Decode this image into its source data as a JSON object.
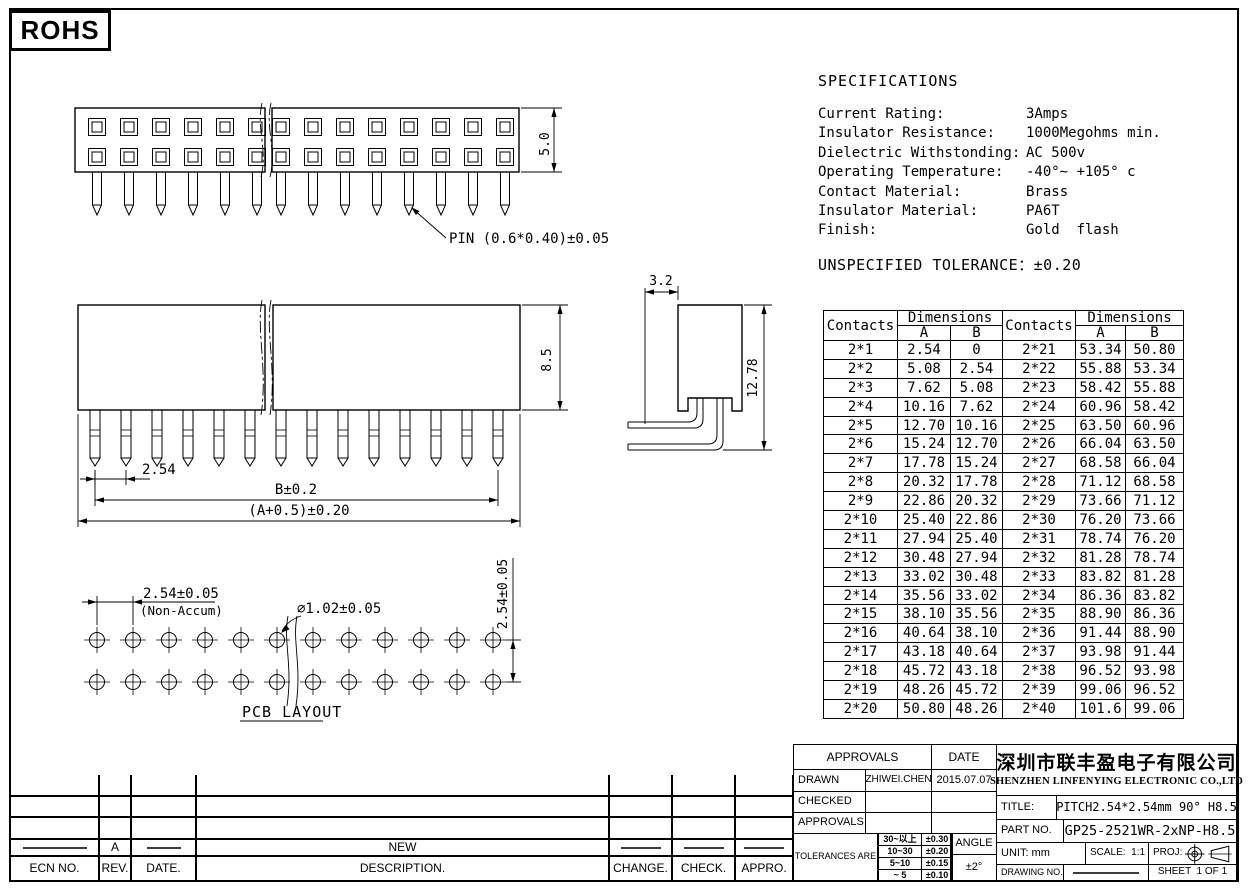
{
  "page": {
    "rohs_label": "ROHS"
  },
  "drawings": {
    "top_view": {
      "pin_label": "PIN (0.6*0.40)±0.05",
      "height_dim": "5.0"
    },
    "front_view": {
      "height_dim": "8.5",
      "pitch_dim": "2.54",
      "row_length_dim": "B±0.2",
      "total_length_dim": "(A+0.5)±0.20"
    },
    "side_view": {
      "depth_dim": "3.2",
      "height_dim": "12.78"
    },
    "pcb_layout": {
      "pitch_dim": "2.54±0.05",
      "pitch_note": "(Non-Accum)",
      "hole_dim": "∅1.02±0.05",
      "row_pitch_dim": "2.54±0.05",
      "caption": "PCB LAYOUT"
    }
  },
  "specifications": {
    "title": "SPECIFICATIONS",
    "items": [
      {
        "label": "Current Rating:",
        "value": "3Amps"
      },
      {
        "label": "Insulator Resistance:",
        "value": "1000Megohms min."
      },
      {
        "label": "Dielectric Withstonding:",
        "value": "AC 500v"
      },
      {
        "label": "Operating Temperature:",
        "value": "-40°∼ +105° c"
      },
      {
        "label": "Contact Material:",
        "value": "Brass"
      },
      {
        "label": "Insulator Material:",
        "value": "PA6T"
      },
      {
        "label": "Finish:",
        "value": "Gold  flash"
      }
    ],
    "tolerance_note": "UNSPECIFIED TOLERANCE：±0.20"
  },
  "dimensions_table": {
    "header": {
      "contacts": "Contacts",
      "dimensions": "Dimensions",
      "a": "A",
      "b": "B"
    },
    "rows": [
      {
        "left": {
          "contacts": "2*1",
          "a": "2.54",
          "b": "0"
        },
        "right": {
          "contacts": "2*21",
          "a": "53.34",
          "b": "50.80"
        }
      },
      {
        "left": {
          "contacts": "2*2",
          "a": "5.08",
          "b": "2.54"
        },
        "right": {
          "contacts": "2*22",
          "a": "55.88",
          "b": "53.34"
        }
      },
      {
        "left": {
          "contacts": "2*3",
          "a": "7.62",
          "b": "5.08"
        },
        "right": {
          "contacts": "2*23",
          "a": "58.42",
          "b": "55.88"
        }
      },
      {
        "left": {
          "contacts": "2*4",
          "a": "10.16",
          "b": "7.62"
        },
        "right": {
          "contacts": "2*24",
          "a": "60.96",
          "b": "58.42"
        }
      },
      {
        "left": {
          "contacts": "2*5",
          "a": "12.70",
          "b": "10.16"
        },
        "right": {
          "contacts": "2*25",
          "a": "63.50",
          "b": "60.96"
        }
      },
      {
        "left": {
          "contacts": "2*6",
          "a": "15.24",
          "b": "12.70"
        },
        "right": {
          "contacts": "2*26",
          "a": "66.04",
          "b": "63.50"
        }
      },
      {
        "left": {
          "contacts": "2*7",
          "a": "17.78",
          "b": "15.24"
        },
        "right": {
          "contacts": "2*27",
          "a": "68.58",
          "b": "66.04"
        }
      },
      {
        "left": {
          "contacts": "2*8",
          "a": "20.32",
          "b": "17.78"
        },
        "right": {
          "contacts": "2*28",
          "a": "71.12",
          "b": "68.58"
        }
      },
      {
        "left": {
          "contacts": "2*9",
          "a": "22.86",
          "b": "20.32"
        },
        "right": {
          "contacts": "2*29",
          "a": "73.66",
          "b": "71.12"
        }
      },
      {
        "left": {
          "contacts": "2*10",
          "a": "25.40",
          "b": "22.86"
        },
        "right": {
          "contacts": "2*30",
          "a": "76.20",
          "b": "73.66"
        }
      },
      {
        "left": {
          "contacts": "2*11",
          "a": "27.94",
          "b": "25.40"
        },
        "right": {
          "contacts": "2*31",
          "a": "78.74",
          "b": "76.20"
        }
      },
      {
        "left": {
          "contacts": "2*12",
          "a": "30.48",
          "b": "27.94"
        },
        "right": {
          "contacts": "2*32",
          "a": "81.28",
          "b": "78.74"
        }
      },
      {
        "left": {
          "contacts": "2*13",
          "a": "33.02",
          "b": "30.48"
        },
        "right": {
          "contacts": "2*33",
          "a": "83.82",
          "b": "81.28"
        }
      },
      {
        "left": {
          "contacts": "2*14",
          "a": "35.56",
          "b": "33.02"
        },
        "right": {
          "contacts": "2*34",
          "a": "86.36",
          "b": "83.82"
        }
      },
      {
        "left": {
          "contacts": "2*15",
          "a": "38.10",
          "b": "35.56"
        },
        "right": {
          "contacts": "2*35",
          "a": "88.90",
          "b": "86.36"
        }
      },
      {
        "left": {
          "contacts": "2*16",
          "a": "40.64",
          "b": "38.10"
        },
        "right": {
          "contacts": "2*36",
          "a": "91.44",
          "b": "88.90"
        }
      },
      {
        "left": {
          "contacts": "2*17",
          "a": "43.18",
          "b": "40.64"
        },
        "right": {
          "contacts": "2*37",
          "a": "93.98",
          "b": "91.44"
        }
      },
      {
        "left": {
          "contacts": "2*18",
          "a": "45.72",
          "b": "43.18"
        },
        "right": {
          "contacts": "2*38",
          "a": "96.52",
          "b": "93.98"
        }
      },
      {
        "left": {
          "contacts": "2*19",
          "a": "48.26",
          "b": "45.72"
        },
        "right": {
          "contacts": "2*39",
          "a": "99.06",
          "b": "96.52"
        }
      },
      {
        "left": {
          "contacts": "2*20",
          "a": "50.80",
          "b": "48.26"
        },
        "right": {
          "contacts": "2*40",
          "a": "101.6",
          "b": "99.06"
        }
      }
    ]
  },
  "title_block": {
    "approvals_header": "APPROVALS",
    "date_header": "DATE",
    "drawn_label": "DRAWN",
    "drawn_name": "ZHIWEI.CHEN",
    "drawn_date": "2015.07.07",
    "checked_label": "CHECKED",
    "approved_label": "APPROVALS",
    "tolerances_label": "TOLERANCES ARE",
    "tolerance_rows": [
      {
        "range": "30~以上",
        "tol": "±0.30"
      },
      {
        "range": "10~30",
        "tol": "±0.20"
      },
      {
        "range": "5~10",
        "tol": "±0.15"
      },
      {
        "range": "~ 5",
        "tol": "±0.10"
      }
    ],
    "angle_label": "ANGLE",
    "angle_value": "±2°",
    "company_cn": "深圳市联丰盈电子有限公司",
    "company_en": "SHENZHEN LINFENYING ELECTRONIC CO.,LTD",
    "title_label": "TITLE:",
    "title_value": "PITCH2.54*2.54mm 90° H8.5",
    "part_label": "PART NO.",
    "part_value": "GP25-2521WR-2xNP-H8.5",
    "unit_label": "UNIT: mm",
    "scale_label": "SCALE:  1:1",
    "proj_label": "PROJ:",
    "drawing_no_label": "DRAWING NO.",
    "sheet_label": "SHEET  1 OF 1"
  },
  "revision_table": {
    "headers": [
      "ECN NO.",
      "REV.",
      "DATE.",
      "DESCRIPTION.",
      "CHANGE.",
      "CHECK.",
      "APPRO."
    ],
    "entry": {
      "rev": "A",
      "description": "NEW"
    }
  }
}
